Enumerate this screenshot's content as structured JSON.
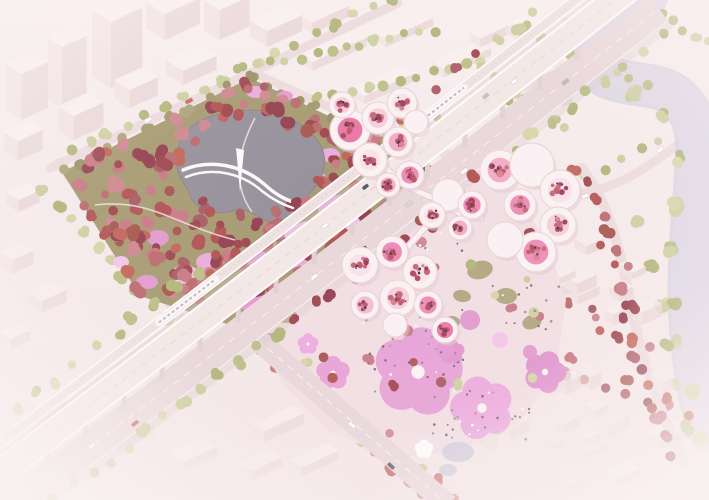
{
  "scene": {
    "description": "aerial-architectural-render-cherry-blossom-masterplan",
    "width": 709,
    "height": 500,
    "seed": 7
  },
  "palette": {
    "bg_top": "#f9f1f0",
    "bg_bottom": "#f3e6e6",
    "block_top": "#faf2f1",
    "block_left": "#f2e4e3",
    "block_right": "#e8d6d6",
    "village_top": "#f7efed",
    "village_left": "#f0e2e0",
    "village_right": "#e9d8d6",
    "park_ground": "#9e9566",
    "lake": "#8d8a93",
    "lake_edge": "#7e7b85",
    "river": "#dcd9e6",
    "river_under": "#cfcbdb",
    "road": "#ecdcdd",
    "south_road": "#e7d6d8",
    "lane": "#fbf7f6",
    "viaduct_ground": "#e8d7d9",
    "viaduct_deck": "#f3e9e7",
    "rail_band": "#eee2e0",
    "pier": "#e0d0cf",
    "shadow": "#d8c8ca",
    "train_body": "#fcfafa",
    "train_stripe": "#b9b4bd",
    "pavilion_white": "#fbf4f5",
    "pavilion_stroke": "#ecd4da",
    "pavilion_shadow": "#e3c4cd",
    "ribbon": "#fbf3f4",
    "ribbon_shadow": "#e8cdd6",
    "plaza": "#f1dfe4",
    "pond": "#cdccdd",
    "lawn": "#a29b6a",
    "green_trees": [
      "#c6cb94",
      "#b5bd7c",
      "#d3d5a2",
      "#aab36e",
      "#c9cf9b"
    ],
    "red_trees": [
      "#96383f",
      "#aa4745",
      "#bc5a4c",
      "#8a3242",
      "#b65f63",
      "#c4707b",
      "#a34e58",
      "#cb7f88",
      "#9d4a3e"
    ],
    "rose_trees": [
      "#c9716b",
      "#d98f85",
      "#c25d55"
    ],
    "olive_trees": [
      "#8f8a58",
      "#a3a06b",
      "#99945f"
    ],
    "court_trees": [
      "#a63b52",
      "#c05a6d",
      "#8f2f45",
      "#d4798b",
      "#b84860"
    ],
    "court_fills": [
      "#f2a6c5",
      "#f8cddd",
      "#ee83b2",
      "#f5b8d2",
      "#fbe3ec",
      "#e96d9f",
      "#fbf2f4"
    ],
    "clearing_pinks": [
      "#e9a8dc",
      "#f2c3e9",
      "#e194ce"
    ],
    "flower_pinks": [
      "#e59cd5",
      "#eba6dd",
      "#df8fcc"
    ],
    "people": [
      "#6b5f66",
      "#a0524e",
      "#8c8c9a",
      "#ffffff",
      "#5d6470"
    ],
    "speck": "#2f2b38"
  },
  "park": {
    "polygon": [
      [
        62,
        172
      ],
      [
        250,
        78
      ],
      [
        432,
        166
      ],
      [
        246,
        330
      ],
      [
        140,
        296
      ]
    ],
    "tree_count": 185,
    "lake_path": "M 192,126 C 214,110 258,104 288,118 C 314,130 330,150 323,172 C 317,192 298,198 303,212 C 306,224 291,230 272,223 C 254,217 249,206 231,211 C 212,216 195,209 190,195 C 186,183 175,176 177,160 C 179,145 177,138 192,126 Z",
    "lake_ellipse": [
      252,
      168,
      66,
      46
    ],
    "bridge_paths": [
      "M 183,170 C 212,158 243,166 264,184 C 274,193 283,199 296,203",
      "M 186,177 C 214,166 243,174 262,191 C 272,199 281,204 293,208"
    ],
    "mast": "M 236,148 L 240,192 L 244,150 Z",
    "clearing_ellipses": [
      [
        305,
        238,
        26,
        16,
        -20
      ],
      [
        338,
        208,
        20,
        13,
        -10
      ],
      [
        262,
        258,
        16,
        11,
        0
      ],
      [
        364,
        243,
        18,
        12,
        -15
      ],
      [
        210,
        262,
        14,
        9,
        0
      ],
      [
        158,
        238,
        11,
        8,
        0
      ],
      [
        250,
        300,
        15,
        10,
        -10
      ],
      [
        256,
        92,
        10,
        6,
        0
      ],
      [
        285,
        96,
        8,
        5,
        0
      ],
      [
        147,
        282,
        11,
        7,
        0
      ],
      [
        121,
        262,
        8,
        6,
        0
      ],
      [
        230,
        130,
        9,
        6,
        0
      ],
      [
        330,
        155,
        10,
        7,
        0
      ],
      [
        318,
        178,
        8,
        6,
        0
      ]
    ],
    "clearing_flowers": [
      [
        300,
        250,
        18,
        0
      ],
      [
        350,
        230,
        14,
        20
      ],
      [
        185,
        275,
        12,
        0
      ]
    ],
    "paths": [
      "M 95,205 C 150,198 175,225 235,240",
      "M 255,118 C 238,150 232,185 252,212",
      "M 330,260 C 300,268 275,285 260,300"
    ],
    "edge_rows": [
      [
        250,
        78,
        432,
        166,
        12
      ],
      [
        62,
        172,
        250,
        78,
        10
      ]
    ]
  },
  "viaduct": {
    "p0": [
      10,
      470
    ],
    "c": [
      330,
      230
    ],
    "p2": [
      640,
      -15
    ],
    "rail_band": [
      -34,
      -22
    ],
    "deck_band": [
      -18,
      10
    ],
    "ground_band": [
      14,
      46
    ],
    "shadow_band": [
      46,
      54
    ],
    "gap_shadow": [
      -21,
      -17
    ],
    "pier_t": [
      0.05,
      0.95,
      0.06
    ],
    "trains": [
      {
        "t0": 0.26,
        "t1": 0.35,
        "off": -28
      },
      {
        "t0": 0.68,
        "t1": 0.745,
        "off": -28
      }
    ],
    "cars_ground": [
      [
        0.1,
        30,
        "#ffffff"
      ],
      [
        0.16,
        38,
        "#c05548"
      ],
      [
        0.45,
        30,
        "#ffffff"
      ],
      [
        0.52,
        38,
        "#3c4254"
      ],
      [
        0.6,
        30,
        "#d8d4d2"
      ],
      [
        0.68,
        38,
        "#ffffff"
      ],
      [
        0.85,
        30,
        "#b8b4b2"
      ]
    ],
    "cars_deck": [
      [
        0.5,
        -4,
        "#ffffff"
      ],
      [
        0.57,
        -10,
        "#444b57"
      ],
      [
        0.63,
        -2,
        "#ffffff"
      ],
      [
        0.76,
        -8,
        "#c2beba"
      ],
      [
        0.8,
        -2,
        "#ffffff"
      ]
    ],
    "se_row": {
      "off": 52,
      "t0": 0.02,
      "t1": 0.98,
      "n": 34,
      "red_zone": [
        0.38,
        0.72
      ]
    },
    "nw_row": {
      "off": -44,
      "t0": 0.05,
      "t1": 0.97,
      "n": 30,
      "red_zone": [
        0.35,
        0.78
      ]
    }
  },
  "river": {
    "path": "M 648,-8 C 630,30 600,38 596,58 C 592,78 620,82 650,86 C 686,92 700,120 697,160 C 694,210 688,260 690,310 C 692,360 700,400 709,430",
    "arm": "M 598,56 C 575,60 562,76 564,98",
    "width": 38,
    "under_width": 44,
    "bank_chain": [
      [
        600,
        66
      ],
      [
        634,
        92
      ],
      [
        664,
        118
      ],
      [
        676,
        158
      ],
      [
        673,
        203
      ],
      [
        669,
        248
      ],
      [
        672,
        298
      ],
      [
        680,
        344
      ],
      [
        690,
        392
      ],
      [
        700,
        434
      ]
    ]
  },
  "roads": {
    "road_a": {
      "x1": 50,
      "y1": 168,
      "x2": 398,
      "y2": 3,
      "w": 9
    },
    "left_road": {
      "x1": 58,
      "y1": 163,
      "x2": 196,
      "y2": 338,
      "w": 9
    },
    "ne_road": {
      "path": "M 252,72 Q 420,152 560,190 Q 612,206 709,118",
      "w": 9
    },
    "east_curve": {
      "path": "M 582,168 C 610,205 620,250 630,300 C 640,352 655,400 684,462",
      "w": 10
    },
    "south_road": {
      "x1": 258,
      "y1": 340,
      "x2": 448,
      "y2": 505,
      "w": 22
    },
    "cars": [
      [
        352,
        425,
        41,
        "#ffffff"
      ],
      [
        391,
        466,
        41,
        "#454b57"
      ],
      [
        148,
        120,
        -27,
        "#ffffff"
      ],
      [
        189,
        101,
        -27,
        "#cc5a4e"
      ],
      [
        585,
        196,
        -18,
        "#ffffff"
      ],
      [
        660,
        150,
        -35,
        "#ffffff"
      ]
    ]
  },
  "tree_rows": [
    {
      "x1": 70,
      "y1": 150,
      "x2": 390,
      "y2": 0,
      "n": 18,
      "pal": "green",
      "rmin": 4,
      "rmax": 7
    },
    {
      "x1": 44,
      "y1": 190,
      "x2": 178,
      "y2": 332,
      "n": 11,
      "pal": "green",
      "rmin": 5,
      "rmax": 8
    },
    {
      "x1": 258,
      "y1": 66,
      "x2": 434,
      "y2": 30,
      "n": 13,
      "pal": "green",
      "rmin": 4,
      "rmax": 6
    },
    {
      "x1": 270,
      "y1": 108,
      "x2": 480,
      "y2": 62,
      "n": 14,
      "pal": "green",
      "rmin": 4,
      "rmax": 6
    },
    {
      "x1": 300,
      "y1": 150,
      "x2": 524,
      "y2": 99,
      "n": 14,
      "pal": "green",
      "rmin": 4,
      "rmax": 6
    },
    {
      "x1": 480,
      "y1": 66,
      "x2": 566,
      "y2": 128,
      "n": 8,
      "pal": "green",
      "rmin": 4,
      "rmax": 6
    },
    {
      "x1": 524,
      "y1": 28,
      "x2": 646,
      "y2": 88,
      "n": 9,
      "pal": "green",
      "rmin": 4,
      "rmax": 6
    },
    {
      "x1": 650,
      "y1": 8,
      "x2": 707,
      "y2": 42,
      "n": 6,
      "pal": "green",
      "rmin": 4,
      "rmax": 6
    },
    {
      "x1": 565,
      "y1": 186,
      "x2": 660,
      "y2": 140,
      "n": 6,
      "pal": "green",
      "rmin": 4,
      "rmax": 6
    },
    {
      "x1": 262,
      "y1": 352,
      "x2": 424,
      "y2": 495,
      "n": 11,
      "pal": "mix",
      "rmin": 5,
      "rmax": 8
    },
    {
      "x1": 296,
      "y1": 356,
      "x2": 456,
      "y2": 498,
      "n": 10,
      "pal": "mix",
      "rmin": 4,
      "rmax": 7
    },
    {
      "x1": 465,
      "y1": 338,
      "x2": 688,
      "y2": 414,
      "n": 12,
      "pal": "red",
      "rmin": 4,
      "rmax": 7
    },
    {
      "x1": 640,
      "y1": 222,
      "x2": 688,
      "y2": 430,
      "n": 6,
      "pal": "green",
      "rmin": 6,
      "rmax": 8
    }
  ],
  "blocks": {
    "clusters": [
      {
        "name": "top-left-towers",
        "opacity": 0.95,
        "boxes": [
          [
            6,
            64,
            30,
            20,
            46
          ],
          [
            48,
            38,
            28,
            18,
            62
          ],
          [
            92,
            10,
            36,
            24,
            66
          ],
          [
            146,
            2,
            40,
            24,
            26
          ],
          [
            4,
            132,
            28,
            18,
            20
          ],
          [
            58,
            106,
            34,
            20,
            24
          ],
          [
            114,
            80,
            32,
            20,
            18
          ],
          [
            166,
            60,
            38,
            22,
            14
          ],
          [
            116,
            150,
            38,
            22,
            16
          ],
          [
            176,
            124,
            42,
            24,
            18
          ],
          [
            230,
            98,
            38,
            22,
            20
          ],
          [
            6,
            192,
            24,
            16,
            12
          ],
          [
            250,
            20,
            40,
            22,
            16
          ],
          [
            204,
            0,
            34,
            20,
            30
          ]
        ]
      },
      {
        "name": "top-center-slabs",
        "opacity": 0.8,
        "boxes": [
          [
            300,
            54,
            62,
            16,
            9
          ],
          [
            374,
            32,
            54,
            15,
            8
          ],
          [
            302,
            16,
            42,
            13,
            11
          ],
          [
            432,
            62,
            54,
            15,
            8
          ],
          [
            352,
            88,
            58,
            16,
            8
          ],
          [
            470,
            32,
            38,
            13,
            9
          ],
          [
            502,
            80,
            52,
            15,
            9
          ],
          [
            560,
            12,
            38,
            13,
            8
          ],
          [
            612,
            2,
            28,
            11,
            9
          ],
          [
            548,
            50,
            44,
            24,
            15
          ],
          [
            506,
            24,
            28,
            16,
            9
          ]
        ]
      },
      {
        "name": "left-mid",
        "opacity": 0.65,
        "boxes": [
          [
            0,
            252,
            24,
            16,
            14
          ],
          [
            28,
            292,
            28,
            18,
            12
          ],
          [
            0,
            332,
            22,
            14,
            10
          ]
        ]
      },
      {
        "name": "bottom-left",
        "opacity": 0.55,
        "boxes": [
          [
            28,
            400,
            38,
            22,
            14
          ],
          [
            98,
            428,
            42,
            24,
            12
          ],
          [
            168,
            452,
            38,
            20,
            10
          ],
          [
            0,
            442,
            28,
            16,
            9
          ],
          [
            238,
            462,
            34,
            18,
            9
          ]
        ]
      },
      {
        "name": "bottom-center",
        "opacity": 0.6,
        "boxes": [
          [
            252,
            424,
            46,
            15,
            11
          ],
          [
            290,
            460,
            42,
            15,
            9
          ]
        ]
      },
      {
        "name": "bottom-right-far",
        "opacity": 0.5,
        "boxes": [
          [
            646,
            432,
            32,
            18,
            9
          ],
          [
            604,
            472,
            28,
            16,
            7
          ]
        ]
      }
    ]
  },
  "village": {
    "region": [
      [
        452,
        345
      ],
      [
        518,
        262
      ],
      [
        572,
        228
      ],
      [
        626,
        240
      ],
      [
        650,
        312
      ],
      [
        670,
        400
      ],
      [
        674,
        470
      ],
      [
        640,
        498
      ],
      [
        470,
        498
      ],
      [
        432,
        430
      ]
    ],
    "box_count": 30,
    "red_tree_count": 24
  },
  "plaza": {
    "polygon": [
      [
        256,
        336
      ],
      [
        318,
        286
      ],
      [
        382,
        232
      ],
      [
        448,
        180
      ],
      [
        472,
        162
      ],
      [
        506,
        182
      ],
      [
        546,
        238
      ],
      [
        566,
        300
      ],
      [
        556,
        372
      ],
      [
        520,
        422
      ],
      [
        462,
        450
      ],
      [
        396,
        458
      ],
      [
        330,
        432
      ],
      [
        284,
        386
      ]
    ],
    "lawns": [
      [
        480,
        270,
        13,
        9,
        -15
      ],
      [
        506,
        296,
        11,
        8,
        0
      ],
      [
        462,
        296,
        9,
        6,
        10
      ],
      [
        532,
        322,
        10,
        7,
        -20
      ],
      [
        287,
        316,
        10,
        7,
        -10
      ],
      [
        270,
        338,
        8,
        5,
        0
      ],
      [
        452,
        322,
        8,
        6,
        0
      ]
    ],
    "big_flowers": [
      [
        418,
        372,
        42,
        10
      ],
      [
        482,
        408,
        30,
        -15
      ],
      [
        545,
        372,
        20,
        20
      ],
      [
        333,
        373,
        16,
        0
      ],
      [
        452,
        352,
        12,
        0
      ],
      [
        308,
        344,
        10,
        0
      ]
    ],
    "small_petals": [
      [
        470,
        320,
        10
      ],
      [
        500,
        340,
        8
      ],
      [
        445,
        350,
        9
      ],
      [
        530,
        352,
        7
      ]
    ],
    "pond": [
      [
        458,
        452,
        16,
        10
      ],
      [
        448,
        470,
        9,
        6
      ]
    ],
    "white_flower": [
      424,
      449,
      9
    ],
    "people_boxes": [
      [
        360,
        308,
        110,
        84,
        40
      ],
      [
        432,
        390,
        100,
        52,
        30
      ],
      [
        484,
        284,
        76,
        48,
        14
      ],
      [
        402,
        212,
        70,
        40,
        12
      ]
    ],
    "red_tree_count": 20,
    "green_tree_count": 8
  },
  "pavilions": {
    "clusters": [
      {
        "name": "north-cluster",
        "petals": [
          [
            350,
            130,
            20
          ],
          [
            378,
            118,
            16
          ],
          [
            402,
            103,
            15
          ],
          [
            370,
            160,
            17
          ],
          [
            398,
            142,
            15
          ],
          [
            416,
            122,
            12
          ],
          [
            342,
            105,
            13
          ],
          [
            410,
            175,
            14
          ],
          [
            388,
            185,
            12
          ]
        ]
      },
      {
        "name": "east-grand-cluster",
        "petals": [
          [
            500,
            170,
            20
          ],
          [
            532,
            165,
            22
          ],
          [
            560,
            190,
            20
          ],
          [
            558,
            225,
            18
          ],
          [
            536,
            252,
            20
          ],
          [
            505,
            240,
            18
          ],
          [
            520,
            205,
            16
          ]
        ]
      },
      {
        "name": "south-cluster",
        "petals": [
          [
            360,
            265,
            18
          ],
          [
            392,
            252,
            16
          ],
          [
            420,
            272,
            17
          ],
          [
            398,
            298,
            18
          ],
          [
            365,
            305,
            14
          ],
          [
            428,
            305,
            14
          ],
          [
            395,
            325,
            12
          ],
          [
            445,
            330,
            13
          ]
        ]
      },
      {
        "name": "mid-cluster",
        "petals": [
          [
            448,
            195,
            16
          ],
          [
            472,
            205,
            14
          ],
          [
            432,
            215,
            13
          ],
          [
            460,
            228,
            12
          ]
        ]
      }
    ],
    "ribbons": [
      "M 383,166 C 402,184 420,196 447,201 C 468,205 478,212 481,218",
      "M 447,201 C 432,222 412,240 399,258",
      "M 478,215 C 464,218 456,213 449,204"
    ]
  }
}
